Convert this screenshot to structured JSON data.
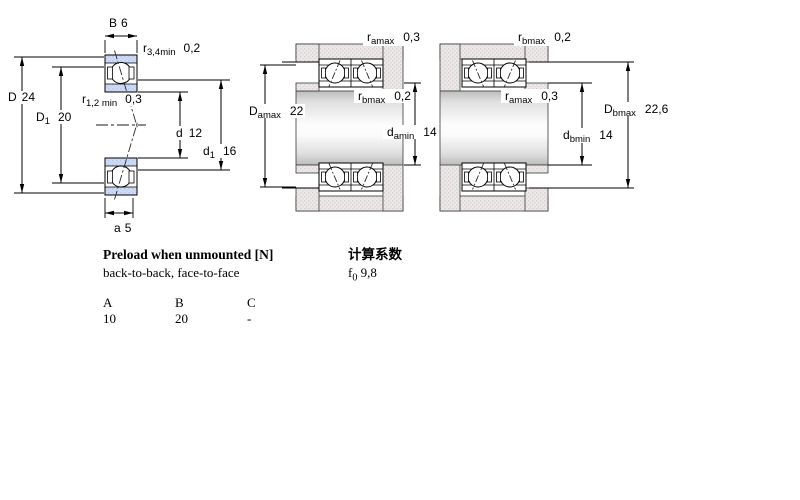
{
  "figures": {
    "bearing": {
      "name": "angular contact bearing cross-section",
      "dims": {
        "B": {
          "sym": "B",
          "val": "6"
        },
        "r34": {
          "sym": "r",
          "sub": "3,4min",
          "val": "0,2"
        },
        "D": {
          "sym": "D",
          "val": "24"
        },
        "D1": {
          "sym": "D",
          "sub": "1",
          "val": "20"
        },
        "r12": {
          "sym": "r",
          "sub": "1,2 min",
          "val": "0,3"
        },
        "d": {
          "sym": "d",
          "val": "12"
        },
        "d1": {
          "sym": "d",
          "sub": "1",
          "val": "16"
        },
        "a": {
          "sym": "a",
          "val": "5"
        }
      }
    },
    "arrangement_a": {
      "name": "mounted pair - abutment dimensions a",
      "dims": {
        "ra": {
          "sym": "r",
          "sub": "amax",
          "val": "0,3"
        },
        "Da": {
          "sym": "D",
          "sub": "amax",
          "val": "22"
        },
        "rb": {
          "sym": "r",
          "sub": "bmax",
          "val": "0,2"
        },
        "da": {
          "sym": "d",
          "sub": "amin",
          "val": "14"
        }
      }
    },
    "arrangement_b": {
      "name": "mounted pair - abutment dimensions b",
      "dims": {
        "rb": {
          "sym": "r",
          "sub": "bmax",
          "val": "0,2"
        },
        "ra": {
          "sym": "r",
          "sub": "amax",
          "val": "0,3"
        },
        "Db": {
          "sym": "D",
          "sub": "bmax",
          "val": "22,6"
        },
        "db": {
          "sym": "d",
          "sub": "bmin",
          "val": "14"
        }
      }
    }
  },
  "preload": {
    "title": "Preload when unmounted [N]",
    "subtitle": "back-to-back, face-to-face",
    "columns": [
      "A",
      "B",
      "C"
    ],
    "values": [
      "10",
      "20",
      "-"
    ]
  },
  "calculation": {
    "title": "计算系数",
    "factor": {
      "sym": "f",
      "sub": "0",
      "val": "9,8"
    }
  },
  "colors": {
    "ring_blue": "#cfdaf3",
    "housing_gray": "#ebe8e8",
    "line": "#000000"
  }
}
